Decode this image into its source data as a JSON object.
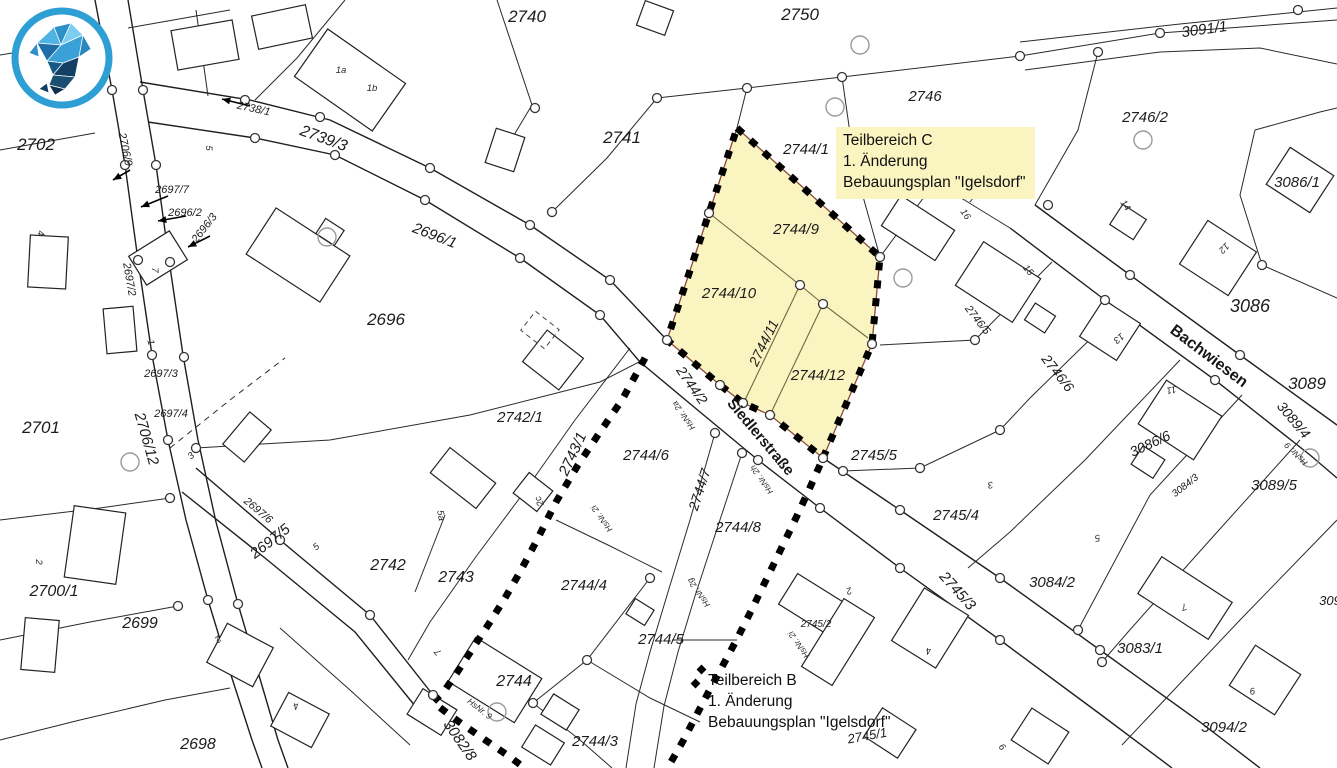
{
  "map": {
    "colors": {
      "background": "#ffffff",
      "line": "#222222",
      "boundary_dash": "#000000",
      "highlight_fill": "#faf4c0",
      "highlight_outline": "#8b4a3b",
      "logo_ring": "#2e9fd4"
    },
    "annotations": {
      "teilbereich_c": {
        "lines": [
          "Teilbereich C",
          "1. Änderung",
          "Bebauungsplan \"Igelsdorf\""
        ]
      },
      "teilbereich_b": {
        "lines": [
          "Teilbereich B",
          "1. Änderung",
          "Bebauungsplan \"Igelsdorf\""
        ]
      }
    },
    "street_labels": [
      {
        "text": "Siedlerstraße",
        "x": 757,
        "y": 440,
        "rot": 50,
        "size": 15
      },
      {
        "text": "Bachwiesen",
        "x": 1206,
        "y": 360,
        "rot": 37,
        "size": 16
      }
    ],
    "parcel_labels": [
      {
        "text": "2702",
        "x": 36,
        "y": 150,
        "rot": 0,
        "size": 17
      },
      {
        "text": "2740",
        "x": 527,
        "y": 22,
        "rot": 0,
        "size": 17
      },
      {
        "text": "2750",
        "x": 800,
        "y": 20,
        "rot": 0,
        "size": 17
      },
      {
        "text": "3091/1",
        "x": 1205,
        "y": 34,
        "rot": -8,
        "size": 15
      },
      {
        "text": "2746",
        "x": 925,
        "y": 101,
        "rot": 0,
        "size": 15
      },
      {
        "text": "2746/2",
        "x": 1145,
        "y": 122,
        "rot": 0,
        "size": 15
      },
      {
        "text": "3086/1",
        "x": 1297,
        "y": 187,
        "rot": 0,
        "size": 15
      },
      {
        "text": "2741",
        "x": 622,
        "y": 143,
        "rot": 0,
        "size": 17
      },
      {
        "text": "2744/1",
        "x": 806,
        "y": 154,
        "rot": 0,
        "size": 15
      },
      {
        "text": "2739/3",
        "x": 322,
        "y": 143,
        "rot": 20,
        "size": 16
      },
      {
        "text": "2738/1",
        "x": 253,
        "y": 112,
        "rot": 12,
        "size": 11
      },
      {
        "text": "2706/9",
        "x": 122,
        "y": 150,
        "rot": 78,
        "size": 11
      },
      {
        "text": "2697/7",
        "x": 172,
        "y": 193,
        "rot": 0,
        "size": 11
      },
      {
        "text": "2696/2",
        "x": 185,
        "y": 216,
        "rot": 0,
        "size": 11
      },
      {
        "text": "2696/3",
        "x": 207,
        "y": 230,
        "rot": -52,
        "size": 11
      },
      {
        "text": "2697/2",
        "x": 126,
        "y": 280,
        "rot": 80,
        "size": 11
      },
      {
        "text": "2696/1",
        "x": 433,
        "y": 240,
        "rot": 21,
        "size": 15
      },
      {
        "text": "2696",
        "x": 386,
        "y": 325,
        "rot": 0,
        "size": 17
      },
      {
        "text": "2697/3",
        "x": 161,
        "y": 377,
        "rot": 0,
        "size": 11
      },
      {
        "text": "2697/4",
        "x": 171,
        "y": 417,
        "rot": 0,
        "size": 11
      },
      {
        "text": "2706/12",
        "x": 142,
        "y": 440,
        "rot": 74,
        "size": 15
      },
      {
        "text": "2701",
        "x": 41,
        "y": 433,
        "rot": 0,
        "size": 17
      },
      {
        "text": "2742/1",
        "x": 520,
        "y": 422,
        "rot": 0,
        "size": 15
      },
      {
        "text": "2743/1",
        "x": 577,
        "y": 456,
        "rot": -65,
        "size": 15
      },
      {
        "text": "2744/2",
        "x": 688,
        "y": 388,
        "rot": 55,
        "size": 14
      },
      {
        "text": "2744/6",
        "x": 646,
        "y": 460,
        "rot": 0,
        "size": 15
      },
      {
        "text": "2744/7",
        "x": 704,
        "y": 491,
        "rot": -72,
        "size": 14
      },
      {
        "text": "2744/8",
        "x": 738,
        "y": 532,
        "rot": 0,
        "size": 15
      },
      {
        "text": "2744/9",
        "x": 796,
        "y": 234,
        "rot": 0,
        "size": 15
      },
      {
        "text": "2744/10",
        "x": 729,
        "y": 298,
        "rot": 0,
        "size": 15
      },
      {
        "text": "2744/11",
        "x": 768,
        "y": 345,
        "rot": -64,
        "size": 14
      },
      {
        "text": "2744/12",
        "x": 818,
        "y": 380,
        "rot": 0,
        "size": 15
      },
      {
        "text": "2745/5",
        "x": 874,
        "y": 460,
        "rot": 0,
        "size": 15
      },
      {
        "text": "2745/4",
        "x": 956,
        "y": 520,
        "rot": 0,
        "size": 15
      },
      {
        "text": "2745/3",
        "x": 954,
        "y": 594,
        "rot": 48,
        "size": 15
      },
      {
        "text": "2745/2",
        "x": 816,
        "y": 627,
        "rot": 0,
        "size": 10
      },
      {
        "text": "2745/1",
        "x": 868,
        "y": 740,
        "rot": -10,
        "size": 13
      },
      {
        "text": "3084/2",
        "x": 1052,
        "y": 587,
        "rot": 0,
        "size": 15
      },
      {
        "text": "3083/1",
        "x": 1140,
        "y": 653,
        "rot": 0,
        "size": 15
      },
      {
        "text": "3094/2",
        "x": 1224,
        "y": 732,
        "rot": 0,
        "size": 15
      },
      {
        "text": "309",
        "x": 1330,
        "y": 605,
        "rot": 0,
        "size": 13
      },
      {
        "text": "3089/5",
        "x": 1274,
        "y": 490,
        "rot": 0,
        "size": 15
      },
      {
        "text": "3089/4",
        "x": 1290,
        "y": 423,
        "rot": 50,
        "size": 14
      },
      {
        "text": "3089",
        "x": 1307,
        "y": 389,
        "rot": 0,
        "size": 17
      },
      {
        "text": "3084/3",
        "x": 1187,
        "y": 488,
        "rot": -38,
        "size": 10
      },
      {
        "text": "3086/6",
        "x": 1152,
        "y": 448,
        "rot": -25,
        "size": 14
      },
      {
        "text": "3086",
        "x": 1250,
        "y": 312,
        "rot": 0,
        "size": 18
      },
      {
        "text": "2746/6",
        "x": 1054,
        "y": 376,
        "rot": 52,
        "size": 14
      },
      {
        "text": "2746/5",
        "x": 975,
        "y": 322,
        "rot": 52,
        "size": 11
      },
      {
        "text": "3082/8",
        "x": 456,
        "y": 743,
        "rot": 55,
        "size": 15
      },
      {
        "text": "2744/4",
        "x": 584,
        "y": 590,
        "rot": 0,
        "size": 15
      },
      {
        "text": "2744/5",
        "x": 661,
        "y": 644,
        "rot": 0,
        "size": 15
      },
      {
        "text": "2744",
        "x": 514,
        "y": 686,
        "rot": 0,
        "size": 16
      },
      {
        "text": "2744/3",
        "x": 595,
        "y": 746,
        "rot": 0,
        "size": 15
      },
      {
        "text": "2743",
        "x": 456,
        "y": 582,
        "rot": 0,
        "size": 16
      },
      {
        "text": "2742",
        "x": 388,
        "y": 570,
        "rot": 0,
        "size": 16
      },
      {
        "text": "2697/6",
        "x": 256,
        "y": 513,
        "rot": 40,
        "size": 11
      },
      {
        "text": "2697/5",
        "x": 273,
        "y": 545,
        "rot": -38,
        "size": 15
      },
      {
        "text": "2700/1",
        "x": 54,
        "y": 596,
        "rot": 0,
        "size": 16
      },
      {
        "text": "2699",
        "x": 140,
        "y": 628,
        "rot": 0,
        "size": 16
      },
      {
        "text": "2698",
        "x": 198,
        "y": 749,
        "rot": 0,
        "size": 16
      }
    ],
    "house_labels": [
      {
        "text": "1a",
        "x": 341,
        "y": 73,
        "rot": 0
      },
      {
        "text": "1b",
        "x": 372,
        "y": 91,
        "rot": 0
      },
      {
        "text": "5",
        "x": 206,
        "y": 148,
        "rot": 90
      },
      {
        "text": "4",
        "x": 38,
        "y": 233,
        "rot": 90
      },
      {
        "text": "7",
        "x": 152,
        "y": 270,
        "rot": 90
      },
      {
        "text": "1",
        "x": 148,
        "y": 343,
        "rot": 75
      },
      {
        "text": "3",
        "x": 193,
        "y": 458,
        "rot": -42
      },
      {
        "text": "2",
        "x": 36,
        "y": 562,
        "rot": 90
      },
      {
        "text": "5",
        "x": 318,
        "y": 549,
        "rot": -40
      },
      {
        "text": "5a",
        "x": 438,
        "y": 516,
        "rot": 80
      },
      {
        "text": "2c",
        "x": 542,
        "y": 500,
        "rot": -115
      },
      {
        "text": "2",
        "x": 216,
        "y": 637,
        "rot": 140
      },
      {
        "text": "4",
        "x": 295,
        "y": 703,
        "rot": 160
      },
      {
        "text": "7",
        "x": 440,
        "y": 650,
        "rot": -135
      },
      {
        "text": "16",
        "x": 963,
        "y": 216,
        "rot": 55
      },
      {
        "text": "15",
        "x": 1026,
        "y": 272,
        "rot": 50
      },
      {
        "text": "13",
        "x": 1117,
        "y": 336,
        "rot": 140
      },
      {
        "text": "12",
        "x": 1222,
        "y": 246,
        "rot": 135
      },
      {
        "text": "11",
        "x": 1171,
        "y": 387,
        "rot": 170
      },
      {
        "text": "14",
        "x": 1123,
        "y": 207,
        "rot": 55
      },
      {
        "text": "3",
        "x": 990,
        "y": 482,
        "rot": 170
      },
      {
        "text": "5",
        "x": 1097,
        "y": 535,
        "rot": 170
      },
      {
        "text": "2",
        "x": 848,
        "y": 588,
        "rot": 160
      },
      {
        "text": "4",
        "x": 928,
        "y": 648,
        "rot": 170
      },
      {
        "text": "7",
        "x": 1183,
        "y": 604,
        "rot": 160
      },
      {
        "text": "9",
        "x": 1252,
        "y": 688,
        "rot": 170
      },
      {
        "text": "9",
        "x": 1005,
        "y": 745,
        "rot": -130
      }
    ],
    "hsnr_labels": [
      {
        "text": "HsNr. 2a",
        "x": 686,
        "y": 414,
        "rot": -125
      },
      {
        "text": "HsNr. 2h",
        "x": 764,
        "y": 478,
        "rot": -125
      },
      {
        "text": "HsNr. 2i",
        "x": 604,
        "y": 517,
        "rot": -125
      },
      {
        "text": "HsNr. 2g",
        "x": 701,
        "y": 591,
        "rot": -125
      },
      {
        "text": "HsNr. 2i",
        "x": 801,
        "y": 643,
        "rot": -125
      },
      {
        "text": "HsNr. 9",
        "x": 478,
        "y": 711,
        "rot": 38
      },
      {
        "text": "HsNr. 9",
        "x": 1298,
        "y": 452,
        "rot": -135
      }
    ]
  }
}
